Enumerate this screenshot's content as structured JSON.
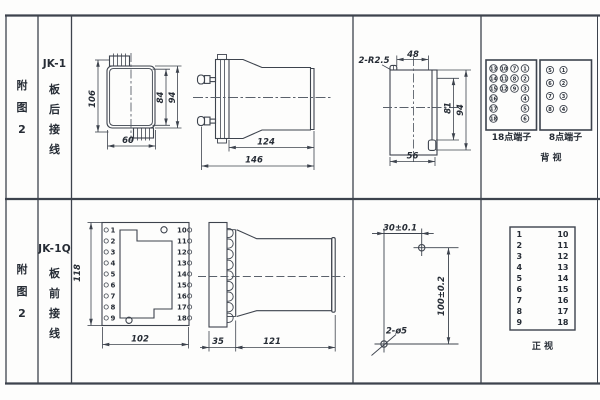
{
  "page": {
    "line_color": "#3d434d",
    "text_color": "#262c35",
    "background": "#fdfdfc"
  },
  "rows": [
    {
      "figure_chars": [
        "附",
        "图",
        "2"
      ],
      "model": "JK-1",
      "wiring_chars": [
        "板",
        "后",
        "接",
        "线"
      ]
    },
    {
      "figure_chars": [
        "附",
        "图",
        "2"
      ],
      "model": "JK-1Q",
      "wiring_chars": [
        "板",
        "前",
        "接",
        "线"
      ]
    }
  ],
  "jk1": {
    "front": {
      "height_overall": "106",
      "height_inner": "84",
      "height_outer": "94",
      "width": "60"
    },
    "side": {
      "body_len": "124",
      "total_len": "146"
    },
    "rear": {
      "corner_radius": "2-R2.5",
      "top_width": "48",
      "inner_h": "81",
      "outer_h": "94",
      "bottom_width": "56"
    }
  },
  "jk1q": {
    "front": {
      "height": "118",
      "width": "102",
      "left_terminals": [
        "1",
        "2",
        "3",
        "4",
        "5",
        "6",
        "7",
        "8",
        "9"
      ],
      "right_terminals": [
        "10",
        "11",
        "12",
        "13",
        "14",
        "15",
        "16",
        "17",
        "18"
      ]
    },
    "side": {
      "flange": "35",
      "body": "121"
    },
    "drill": {
      "h_dist": "30±0.1",
      "v_dist": "100±0.2",
      "hole_label": "2-ø5"
    }
  },
  "terminals": {
    "t18": {
      "caption": "18点端子",
      "matrix": [
        [
          "13",
          "10",
          "7",
          "1"
        ],
        [
          "14",
          "11",
          "8",
          "2"
        ],
        [
          "15",
          "12",
          "9",
          "3"
        ],
        [
          "16",
          null,
          null,
          "4"
        ],
        [
          "17",
          null,
          null,
          "5"
        ],
        [
          "18",
          null,
          null,
          "6"
        ]
      ]
    },
    "t8": {
      "caption": "8点端子",
      "matrix": [
        [
          "5",
          "1"
        ],
        [
          "6",
          "2"
        ],
        [
          "7",
          "3"
        ],
        [
          "8",
          "4"
        ]
      ]
    },
    "back_view_caption": "背  视",
    "front_view_caption": "正  视",
    "table": {
      "left": [
        "1",
        "2",
        "3",
        "4",
        "5",
        "6",
        "7",
        "8",
        "9"
      ],
      "right": [
        "10",
        "11",
        "12",
        "13",
        "14",
        "15",
        "16",
        "17",
        "18"
      ]
    }
  }
}
